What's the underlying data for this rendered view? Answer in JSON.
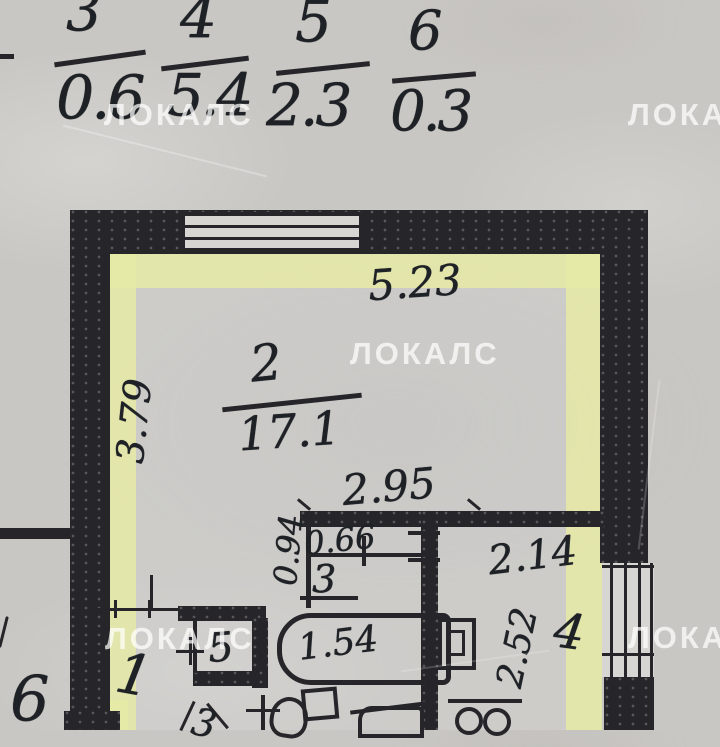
{
  "watermark": {
    "text": "ЛОКАЛС"
  },
  "fractions": {
    "items": [
      {
        "num": "3",
        "den": "0.6"
      },
      {
        "num": "4",
        "den": "5.4"
      },
      {
        "num": "5",
        "den": "2.3"
      },
      {
        "num": "6",
        "den": "0.3"
      }
    ]
  },
  "plan": {
    "room2": {
      "number": "2",
      "area": "17.1",
      "dim_top": "5.23",
      "dim_left": "3.79",
      "dim_bottom": "2.95"
    },
    "closet3": {
      "number": "3",
      "dim_width": "0.66",
      "dim_depth": "0.94"
    },
    "room4": {
      "number": "4",
      "dim_width": "2.14",
      "dim_left": "2.52"
    },
    "closet5": {
      "number": "5"
    },
    "hall1": {
      "number": "1"
    },
    "room6": {
      "number": "6"
    },
    "bathtub": {
      "label": "1.54"
    },
    "partial_label": "3"
  },
  "colors": {
    "ink": "#1e2125",
    "wall": "#26262a",
    "highlight": "#e6eaa6",
    "paper": "#c9c7c3"
  }
}
